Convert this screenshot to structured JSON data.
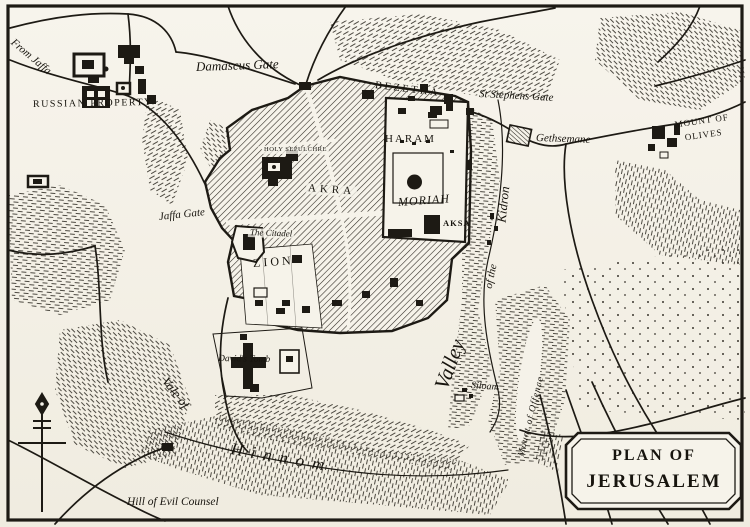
{
  "map": {
    "colors": {
      "ink": "#1d1a14",
      "paper": "#f6f3ea"
    },
    "title_box": {
      "line1": "PLAN OF",
      "line2": "JERUSALEM"
    },
    "labels": {
      "from_jaffa": "From Jaffa",
      "russian_property": "RUSSIAN PROPERTY",
      "damascus_gate": "Damascus Gate",
      "bezetha": "BEZETHA",
      "st_stephens_gate": "St Stephens Gate",
      "gethsemane": "Gethsemane",
      "mount_of_olives_line1": "MOUNT OF",
      "mount_of_olives_line2": "OLIVES",
      "holy_sepulchre": "HOLY SEPULCHRE",
      "akra": "AKRA",
      "haram": "HARAM",
      "moriah": "MORIAH",
      "aksa": "AKSA",
      "jaffa_gate": "Jaffa Gate",
      "the_citadel": "The Citadel",
      "zion": "ZION",
      "davids_tomb": "David's Tomb",
      "siloam": "Siloam",
      "valley": "Valley",
      "of_the": "of the",
      "kidron": "Kidron",
      "vale_of": "Vale of",
      "hinnom": "Hinnom",
      "mount_of_offence": "Mount of Offence",
      "hill_of_evil_counsel": "Hill of Evil Counsel"
    },
    "icons": {
      "compass": "north-arrow"
    }
  }
}
